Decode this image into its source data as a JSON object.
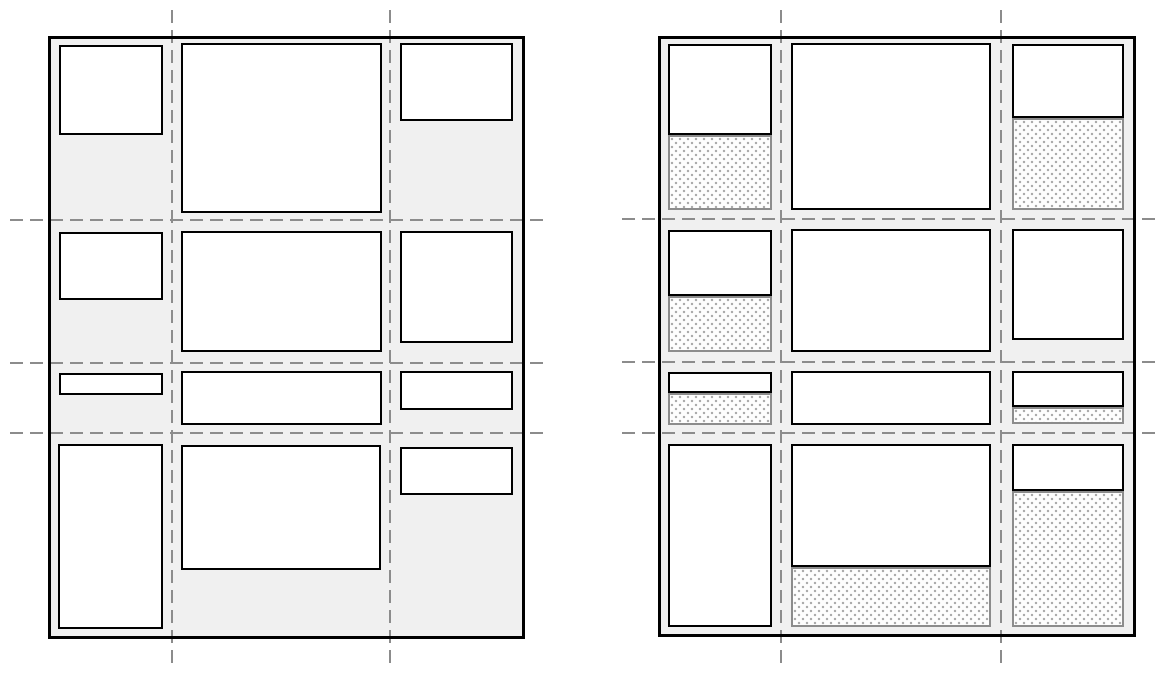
{
  "colors": {
    "canvas_bg": "#ffffff",
    "container_bg": "#f0f0f0",
    "container_border": "#000000",
    "item_fill": "#ffffff",
    "item_border": "#000000",
    "gridline": "#8c8c8c",
    "track_border": "#8c8c8c",
    "track_dot": "#a8a8a8",
    "track_fill": "#fdfdfd"
  },
  "figures": [
    {
      "id": "grid-items-figure",
      "container": {
        "x": 48,
        "y": 36,
        "w": 477,
        "h": 603
      },
      "gridlines": {
        "vertical": [
          {
            "x": 171,
            "y1": 10,
            "y2": 668
          },
          {
            "x": 389,
            "y1": 10,
            "y2": 668
          }
        ],
        "horizontal": [
          {
            "y": 219,
            "x1": 10,
            "x2": 545
          },
          {
            "y": 362,
            "x1": 10,
            "x2": 545
          },
          {
            "y": 432,
            "x1": 10,
            "x2": 545
          }
        ]
      },
      "items": [
        {
          "x": 59,
          "y": 45,
          "w": 104,
          "h": 90
        },
        {
          "x": 181,
          "y": 43,
          "w": 201,
          "h": 170
        },
        {
          "x": 400,
          "y": 43,
          "w": 113,
          "h": 78
        },
        {
          "x": 59,
          "y": 232,
          "w": 104,
          "h": 68
        },
        {
          "x": 181,
          "y": 231,
          "w": 201,
          "h": 121
        },
        {
          "x": 400,
          "y": 231,
          "w": 113,
          "h": 112
        },
        {
          "x": 59,
          "y": 373,
          "w": 104,
          "h": 22
        },
        {
          "x": 181,
          "y": 371,
          "w": 201,
          "h": 54
        },
        {
          "x": 400,
          "y": 371,
          "w": 113,
          "h": 39
        },
        {
          "x": 58,
          "y": 444,
          "w": 105,
          "h": 185
        },
        {
          "x": 181,
          "y": 445,
          "w": 200,
          "h": 125
        },
        {
          "x": 400,
          "y": 447,
          "w": 113,
          "h": 48
        }
      ]
    },
    {
      "id": "grid-tracks-figure",
      "container": {
        "x": 658,
        "y": 36,
        "w": 478,
        "h": 601
      },
      "gridlines": {
        "vertical": [
          {
            "x": 780,
            "y1": 10,
            "y2": 668
          },
          {
            "x": 1000,
            "y1": 10,
            "y2": 668
          }
        ],
        "horizontal": [
          {
            "y": 218,
            "x1": 622,
            "x2": 1157
          },
          {
            "y": 361,
            "x1": 622,
            "x2": 1157
          },
          {
            "y": 432,
            "x1": 622,
            "x2": 1157
          }
        ]
      },
      "items": [
        {
          "x": 668,
          "y": 44,
          "w": 104,
          "h": 91,
          "track": {
            "x": 668,
            "y": 135,
            "w": 104,
            "h": 75
          }
        },
        {
          "x": 791,
          "y": 43,
          "w": 200,
          "h": 167,
          "track": null
        },
        {
          "x": 1012,
          "y": 44,
          "w": 112,
          "h": 74,
          "track": {
            "x": 1012,
            "y": 118,
            "w": 112,
            "h": 92
          }
        },
        {
          "x": 668,
          "y": 230,
          "w": 104,
          "h": 66,
          "track": {
            "x": 668,
            "y": 296,
            "w": 104,
            "h": 56
          }
        },
        {
          "x": 791,
          "y": 229,
          "w": 200,
          "h": 123,
          "track": null
        },
        {
          "x": 1012,
          "y": 229,
          "w": 112,
          "h": 111,
          "track": null
        },
        {
          "x": 668,
          "y": 372,
          "w": 104,
          "h": 21,
          "track": {
            "x": 668,
            "y": 393,
            "w": 104,
            "h": 32
          }
        },
        {
          "x": 791,
          "y": 371,
          "w": 200,
          "h": 54,
          "track": null
        },
        {
          "x": 1012,
          "y": 371,
          "w": 112,
          "h": 36,
          "track": {
            "x": 1012,
            "y": 407,
            "w": 112,
            "h": 17
          }
        },
        {
          "x": 668,
          "y": 444,
          "w": 104,
          "h": 183,
          "track": null
        },
        {
          "x": 791,
          "y": 444,
          "w": 200,
          "h": 123,
          "track": {
            "x": 791,
            "y": 567,
            "w": 200,
            "h": 60
          }
        },
        {
          "x": 1012,
          "y": 444,
          "w": 112,
          "h": 47,
          "track": {
            "x": 1012,
            "y": 491,
            "w": 112,
            "h": 136
          }
        }
      ]
    }
  ]
}
